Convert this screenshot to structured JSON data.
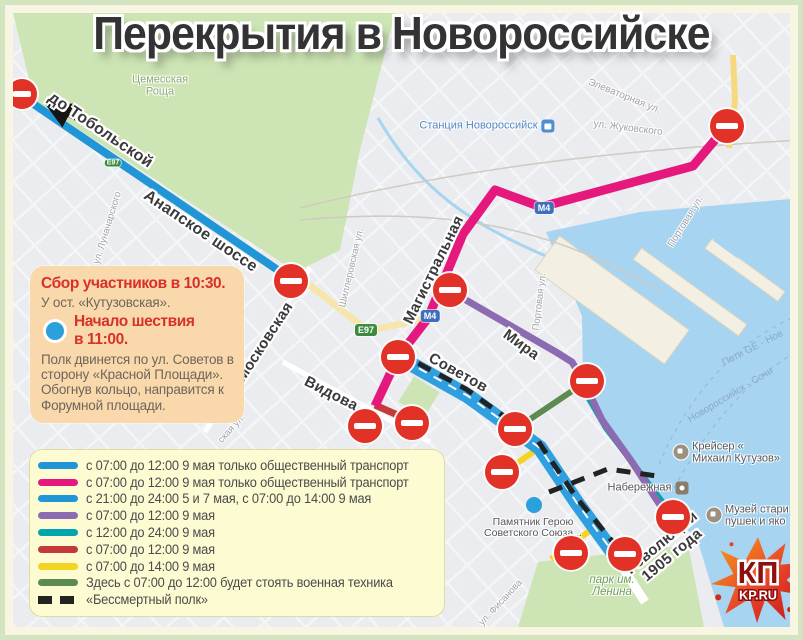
{
  "title": "Перекрытия в Новороссийске",
  "info_box": {
    "heading": "Сбор участников в 10:30.",
    "stop": "У ост.  «Кутузовская».",
    "start_line1": "Начало шествия",
    "start_line2": "в 11:00.",
    "body": "Полк двинется по ул. Советов в сторону «Красной Площади». Обогнув кольцо, направится к Форумной площади."
  },
  "legend": {
    "items": [
      {
        "color": "#2196d6",
        "label": "с 07:00 до 12:00 9 мая только общественный транспорт"
      },
      {
        "color": "#e5187d",
        "label": "с 07:00 до 12:00 9 мая только общественный транспорт"
      },
      {
        "color": "#2196d6",
        "label": "с 21:00 до 24:00 5 и 7 мая, с 07:00 до 14:00 9 мая"
      },
      {
        "color": "#8c6bb0",
        "label": "с 07:00 до 12:00 9 мая"
      },
      {
        "color": "#00a5ad",
        "label": "с 12:00 до 24:00 9 мая"
      },
      {
        "color": "#c33a38",
        "label": "с 07:00 до 12:00 9 мая"
      },
      {
        "color": "#f5d321",
        "label": "с 07:00 до 14:00 9 мая"
      },
      {
        "color": "#5c8a50",
        "label": "Здесь с 07:00 до 12:00 будет стоять военная техника"
      },
      {
        "color": "#222222",
        "label": "«Бессмертный полк»",
        "dashed": true
      }
    ]
  },
  "map": {
    "streets_bold": [
      {
        "text": "до Тобольской"
      },
      {
        "text": "Анапское шоссе"
      },
      {
        "text": "Московская"
      },
      {
        "text": "Магистральная"
      },
      {
        "text": "Видова"
      },
      {
        "text": "Советов"
      },
      {
        "text": "Мира"
      }
    ],
    "revolution_label": {
      "line1": "Революции",
      "line2": "1905 года"
    },
    "streets_small": [
      {
        "text": "ул. Луначарского"
      },
      {
        "text": "Шиллеровская ул."
      },
      {
        "text": "ская ул."
      },
      {
        "text": "Элеваторная ул."
      },
      {
        "text": "ул. Жуковского"
      },
      {
        "text": "Портовая ул."
      },
      {
        "text": "Портовая ул."
      },
      {
        "text": "ул. Фисанова"
      }
    ],
    "pois": {
      "forest": {
        "line1": "Цемесская",
        "line2": "Роща"
      },
      "station": {
        "text": "Станция Новороссийск"
      },
      "cruiser": {
        "line1": "Крейсер «",
        "line2": "Михаил Кутузов»"
      },
      "embankment": {
        "text": "Набережная"
      },
      "museum": {
        "line1": "Музей стари",
        "line2": "пушек и яко"
      },
      "park": {
        "line1": "парк им.",
        "line2": "Ленина"
      },
      "monument": {
        "line1": "Памятник Герою",
        "line2": "Советского Союза..."
      }
    },
    "water_labels": [
      {
        "text": "Поти GE - Нов"
      },
      {
        "text": "Новороссийск - Сочи"
      }
    ],
    "badges": {
      "e97": "E97",
      "m4": "М4"
    }
  },
  "logo": {
    "kp": "КП",
    "kpru": "KP.RU"
  },
  "colors": {
    "route_blue": "#2196d6",
    "route_pink": "#e5187d",
    "route_purple": "#8c6bb0",
    "route_teal": "#00a5ad",
    "route_red": "#c33a38",
    "route_yellow": "#f5d321",
    "route_green": "#5c8a50",
    "route_black": "#222222",
    "sovetov_blue": "#2f9fe0",
    "park": "#cde5b4",
    "water": "#a7d4f0",
    "land": "#eaecef",
    "pier": "#f3efe2",
    "sign_red": "#e23126",
    "marker_blue": "#2aa0dd"
  }
}
